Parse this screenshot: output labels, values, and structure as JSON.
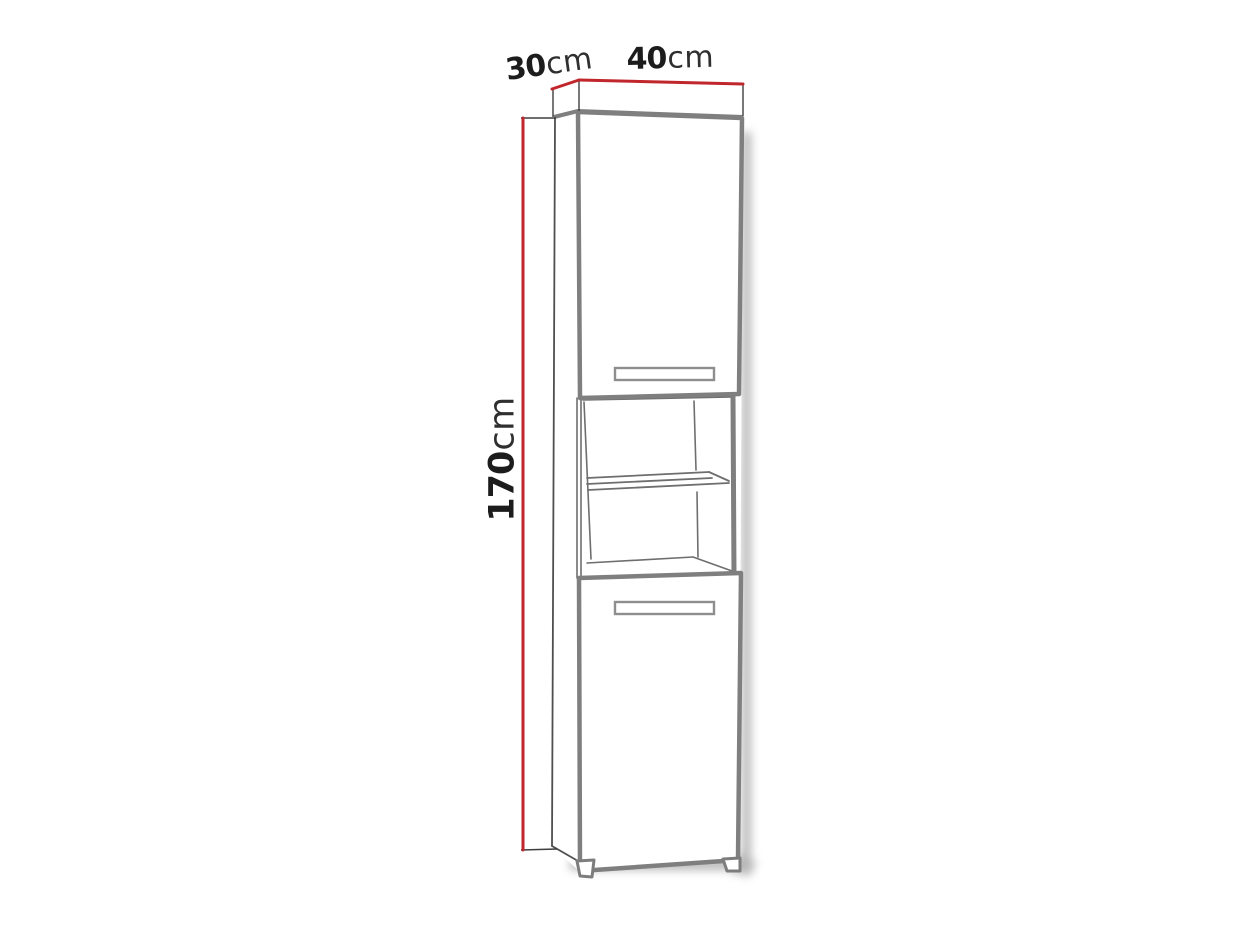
{
  "diagram": {
    "subject": "tall two-door cabinet with open middle shelf",
    "view": "front perspective line drawing",
    "dimensions": {
      "depth": {
        "value": "30",
        "unit": "cm"
      },
      "width": {
        "value": "40",
        "unit": "cm"
      },
      "height": {
        "value": "170",
        "unit": "cm"
      }
    }
  },
  "colors": {
    "accent-red": "#c0262c",
    "line-gray": "#7f7f7f",
    "line-mid": "#6e6e6e",
    "line-dark": "#3f3f3f",
    "text-strong": "#1c1c1c",
    "text-unit": "#2f2f2f",
    "shadow": "#9a9a9a",
    "bg": "#ffffff"
  }
}
